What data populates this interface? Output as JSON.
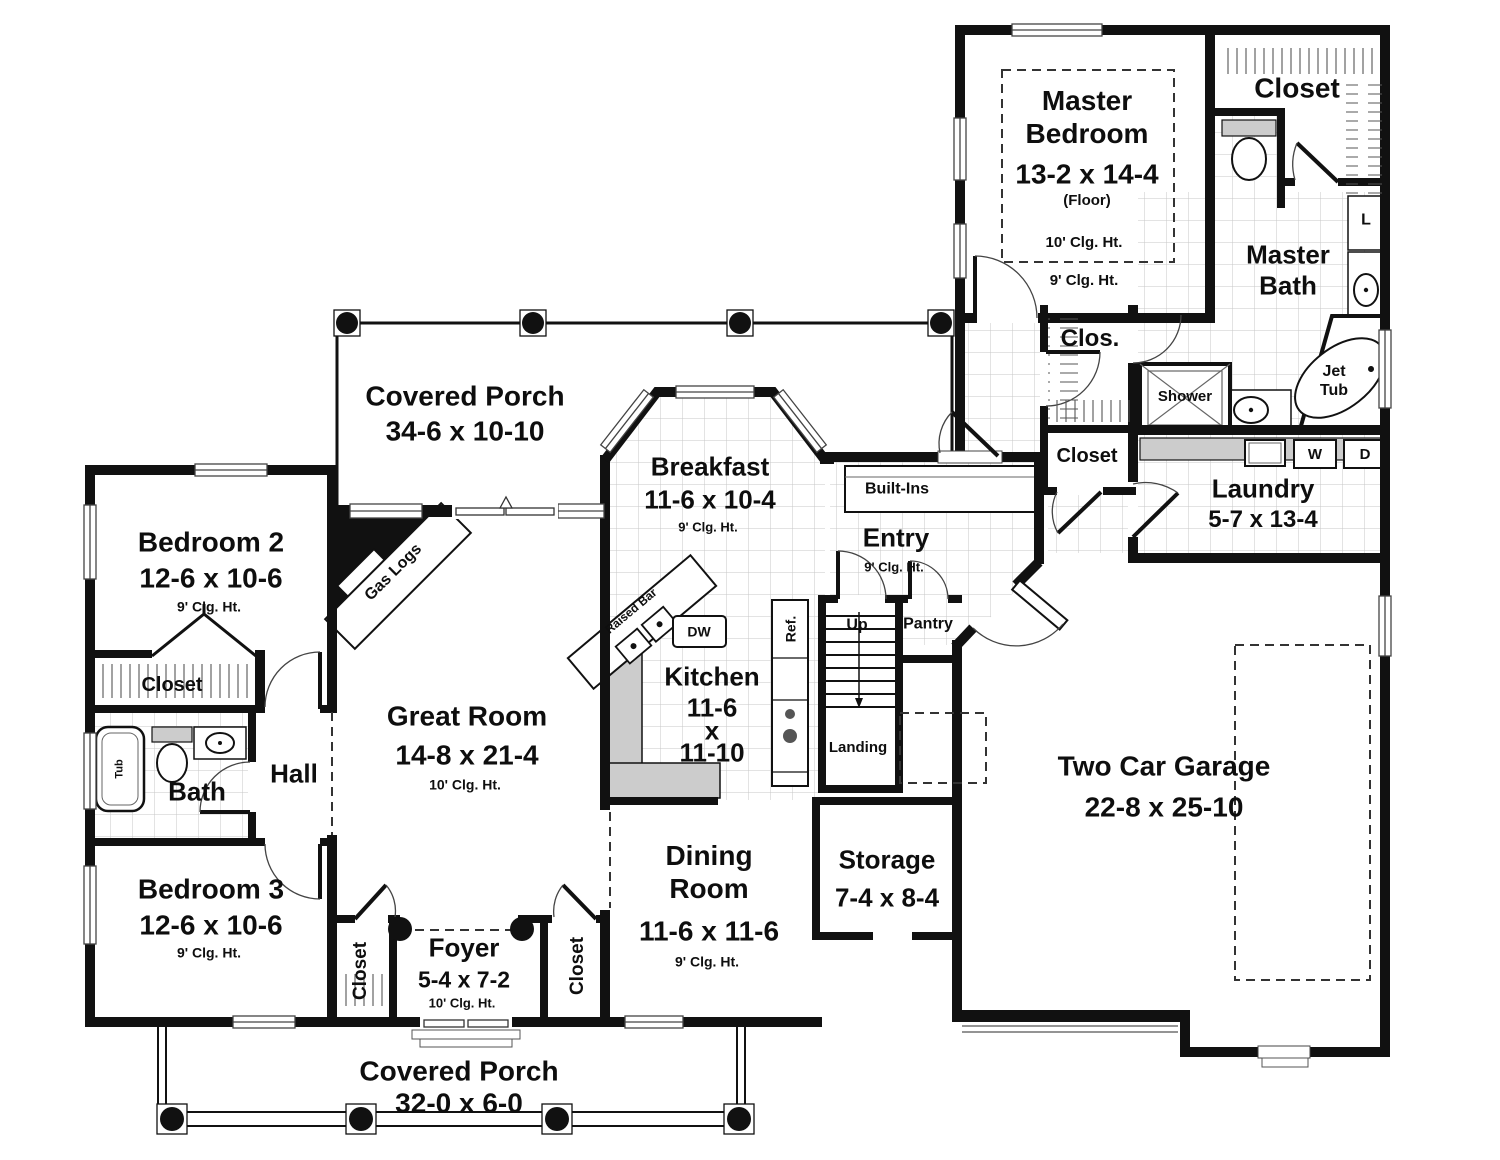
{
  "rooms": {
    "covered_porch_rear": {
      "name": "Covered Porch",
      "dims": "34-6 x 10-10"
    },
    "master_bedroom": {
      "name": "Master Bedroom",
      "dims": "13-2 x 14-4",
      "note": "(Floor)",
      "clg_tray": "10' Clg. Ht.",
      "clg": "9' Clg. Ht."
    },
    "master_closet": {
      "name": "Closet"
    },
    "master_bath": {
      "name": "Master Bath"
    },
    "clos": {
      "name": "Clos."
    },
    "hall_closet": {
      "name": "Closet"
    },
    "laundry": {
      "name": "Laundry",
      "dims": "5-7 x 13-4"
    },
    "breakfast": {
      "name": "Breakfast",
      "dims": "11-6 x 10-4",
      "clg": "9' Clg. Ht."
    },
    "entry": {
      "name": "Entry",
      "clg": "9' Clg. Ht."
    },
    "bedroom2": {
      "name": "Bedroom 2",
      "dims": "12-6 x 10-6",
      "clg": "9' Clg. Ht."
    },
    "bedroom2_closet": {
      "name": "Closet"
    },
    "bath": {
      "name": "Bath"
    },
    "hall": {
      "name": "Hall"
    },
    "great_room": {
      "name": "Great Room",
      "dims": "14-8 x 21-4",
      "clg": "10' Clg. Ht."
    },
    "kitchen": {
      "name": "Kitchen",
      "dim_w": "11-6",
      "dim_x": "x",
      "dim_l": "11-10"
    },
    "bedroom3": {
      "name": "Bedroom 3",
      "dims": "12-6 x 10-6",
      "clg": "9' Clg. Ht."
    },
    "foyer": {
      "name": "Foyer",
      "dims": "5-4 x 7-2",
      "clg": "10' Clg. Ht."
    },
    "foyer_closet_left": {
      "name": "Closet"
    },
    "foyer_closet_right": {
      "name": "Closet"
    },
    "dining": {
      "name": "Dining Room",
      "dims": "11-6 x 11-6",
      "clg": "9' Clg. Ht."
    },
    "storage": {
      "name": "Storage",
      "dims": "7-4 x 8-4"
    },
    "garage": {
      "name": "Two Car Garage",
      "dims": "22-8 x 25-10"
    },
    "covered_porch_front": {
      "name": "Covered Porch",
      "dims": "32-0 x 6-0"
    }
  },
  "fixtures": {
    "gas_logs": "Gas Logs",
    "raised_bar": "Raised Bar",
    "dishwasher": "DW",
    "refrigerator": "Ref.",
    "stairs_up": "Up",
    "landing": "Landing",
    "pantry": "Pantry",
    "built_ins": "Built-Ins",
    "shower": "Shower",
    "jet_tub": "Jet Tub",
    "washer": "W",
    "dryer": "D",
    "linen": "L",
    "tub": "Tub"
  },
  "colors": {
    "wall": "#111111",
    "counter": "#cccccc",
    "tile_line": "#c7c7c7"
  }
}
